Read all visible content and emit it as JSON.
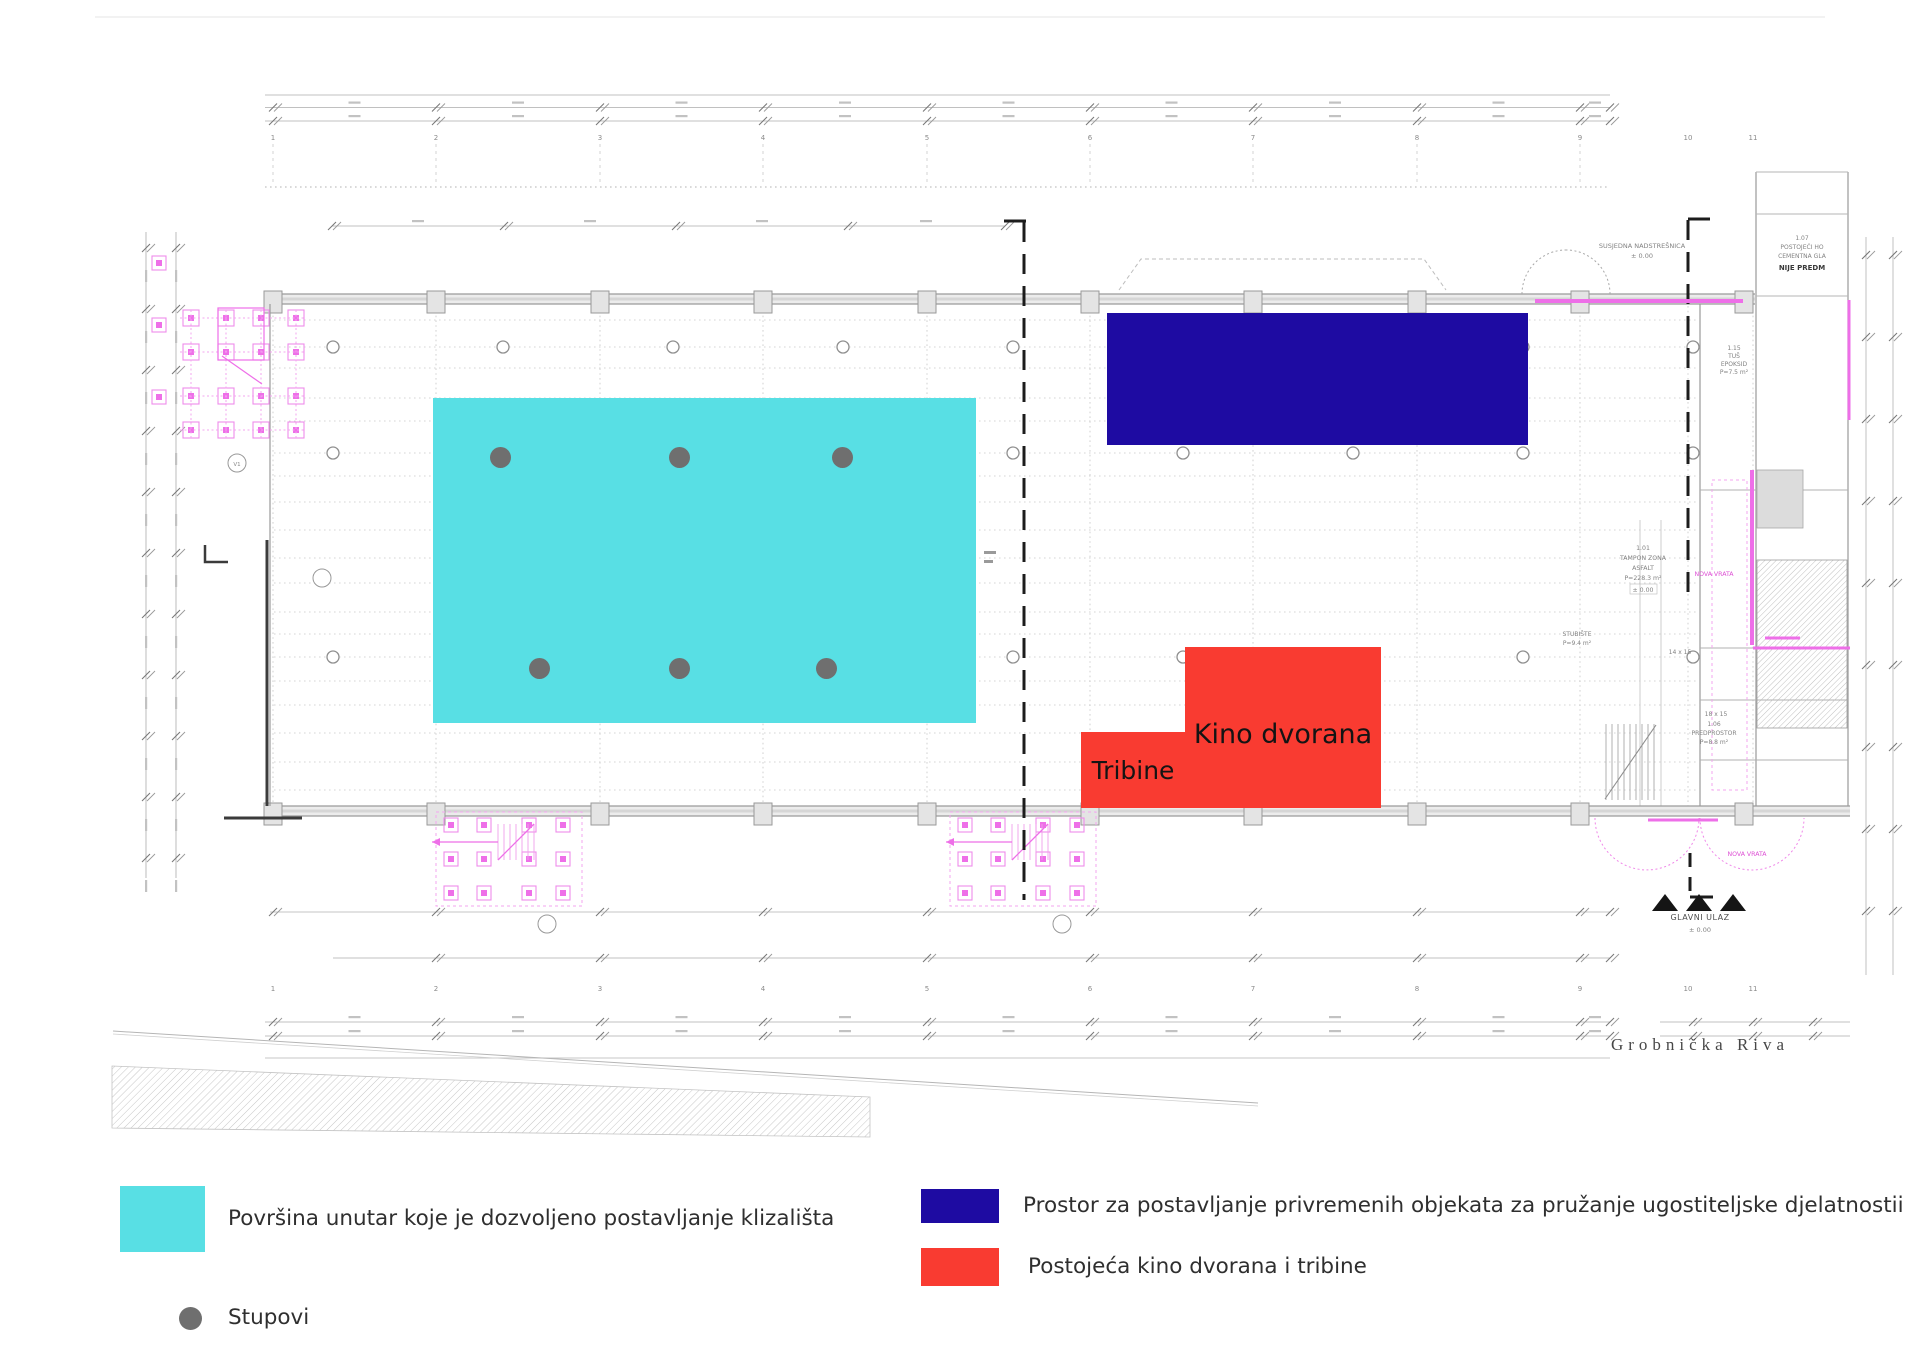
{
  "colors": {
    "rink": "#58DFE4",
    "hospitality": "#1E0BA2",
    "cinema": "#F93B31",
    "column_dot": "#6F6F6F",
    "cad_pink": "#EE6FE8",
    "cad_line": "#ABABAB"
  },
  "zones": {
    "rink": {
      "x": 433,
      "y": 398,
      "w": 543,
      "h": 325
    },
    "hospitality": {
      "x": 1107,
      "y": 313,
      "w": 421,
      "h": 132
    },
    "cinema": {
      "x": 1185,
      "y": 647,
      "w": 196,
      "h": 161,
      "label": "Kino dvorana"
    },
    "stands": {
      "x": 1081,
      "y": 732,
      "w": 104,
      "h": 76,
      "label": "Tribine"
    }
  },
  "columns": [
    {
      "x": 500,
      "y": 457
    },
    {
      "x": 679,
      "y": 457
    },
    {
      "x": 842,
      "y": 457
    },
    {
      "x": 539,
      "y": 668
    },
    {
      "x": 679,
      "y": 668
    },
    {
      "x": 826,
      "y": 668
    }
  ],
  "plan": {
    "axis_numbers": [
      "1",
      "2",
      "3",
      "4",
      "5",
      "6",
      "7",
      "8",
      "9",
      "10",
      "11"
    ],
    "labels": {
      "cinema": "Kino dvorana",
      "stands": "Tribine",
      "street": "Grobnička Riva",
      "main_entrance": "GLAVNI ULAZ",
      "main_entrance_level": "± 0.00"
    },
    "annotations": {
      "susjedna": {
        "l1": "SUSJEDNA NADSTREŠNICA",
        "l2": "± 0.00"
      },
      "hodnik": {
        "l1": "1.07",
        "l2": "POSTOJEĆI HO",
        "l3": "CEMENTNA GLA",
        "l4": "NIJE PREDM"
      },
      "tus": {
        "l1": "1.15",
        "l2": "TUŠ",
        "l3": "EPOKSID",
        "l4": "P=7.5 m²"
      },
      "tampon": {
        "l1": "1.01",
        "l2": "TAMPON ZONA",
        "l3": "ASFALT",
        "l4": "P=228.3 m²",
        "l5": "± 0.00"
      },
      "stubiste": {
        "l1": "STUBIŠTE",
        "l2": "P=9.4 m²"
      },
      "pred": {
        "l0": "18 x 15",
        "l1": "1.06",
        "l2": "PREDPROSTOR",
        "l3": "P=8.8 m²"
      },
      "dim14": "14 x 15",
      "nova_vrata": "NOVA VRATA"
    }
  },
  "legend": {
    "items": [
      {
        "shape": "rect",
        "color": "#58DFE4",
        "label": "Površina unutar koje je dozvoljeno postavljanje klizališta"
      },
      {
        "shape": "dot",
        "color": "#6F6F6F",
        "label": "Stupovi"
      },
      {
        "shape": "rect",
        "color": "#1E0BA2",
        "label": "Prostor za postavljanje privremenih objekata za pružanje ugostiteljske djelatnostii"
      },
      {
        "shape": "rect",
        "color": "#F93B31",
        "label": "Postojeća kino dvorana i tribine"
      }
    ]
  }
}
